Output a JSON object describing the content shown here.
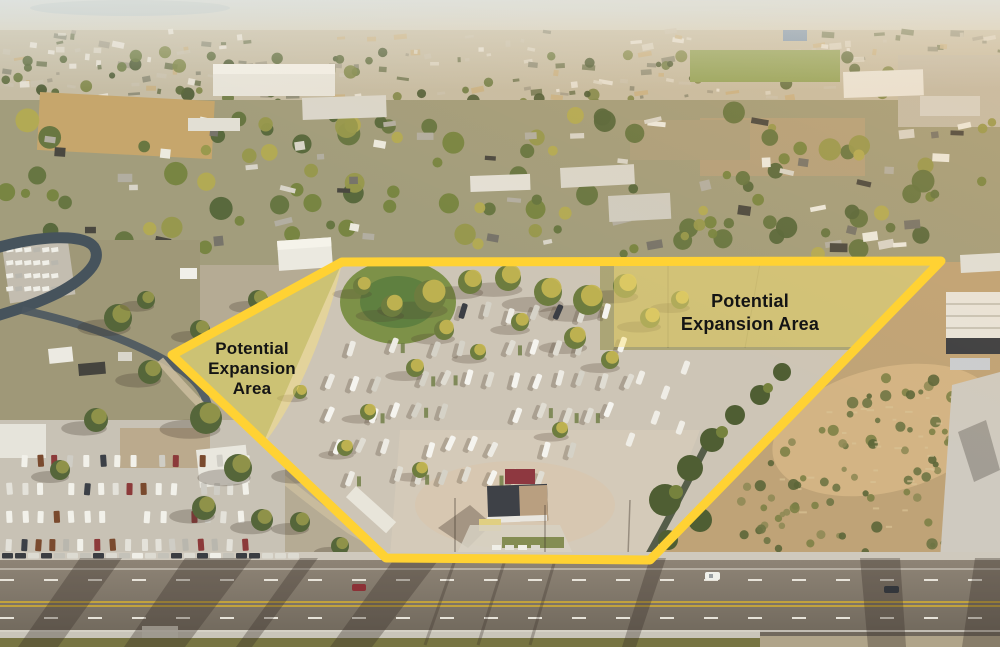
{
  "image": {
    "kind": "annotated aerial photograph",
    "subject": "RV park property with outlined boundary and highlighted expansion areas"
  },
  "annotations": {
    "boundary": {
      "color": "#FFD233"
    },
    "highlight": {
      "fill": "#FFE47A",
      "opacity": "0.45"
    },
    "labels": {
      "left": {
        "lines": [
          "Potential",
          "Expansion",
          "Area"
        ],
        "text_color": "#141414"
      },
      "right": {
        "lines": [
          "Potential",
          "Expansion Area"
        ],
        "text_color": "#141414"
      }
    }
  }
}
